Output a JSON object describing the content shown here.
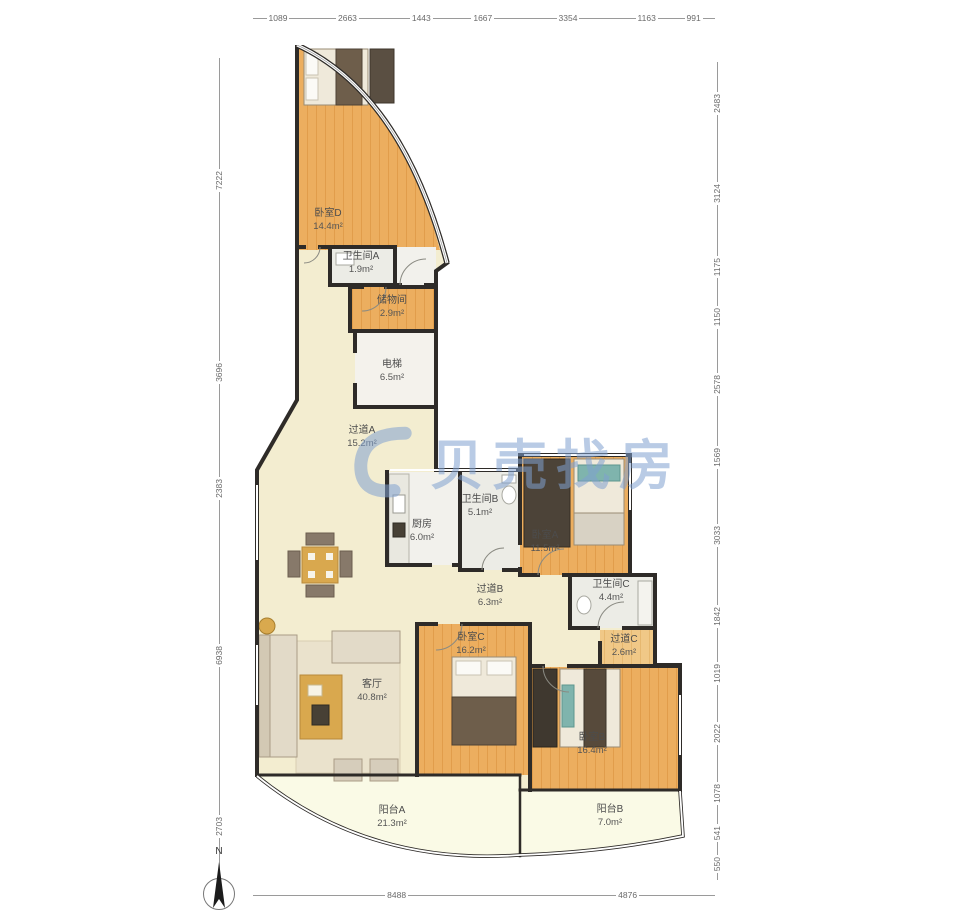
{
  "watermark": {
    "text": "贝壳找房",
    "color": "#80a0d0"
  },
  "compass": {
    "label": "N"
  },
  "rulers": {
    "top": [
      "1089",
      "2663",
      "1443",
      "1667",
      "3354",
      "1163",
      "991"
    ],
    "left": [
      "7222",
      "3696",
      "2383",
      "6938",
      "2703"
    ],
    "right": [
      "2483",
      "3124",
      "1175",
      "1150",
      "2578",
      "1569",
      "3033",
      "1842",
      "1019",
      "2022",
      "1078",
      "541",
      "550"
    ],
    "bottom": [
      "8488",
      "4876"
    ]
  },
  "rooms": [
    {
      "id": "bedroom-d",
      "name": "卧室D",
      "area": "14.4m²"
    },
    {
      "id": "bathroom-a",
      "name": "卫生间A",
      "area": "1.9m²"
    },
    {
      "id": "storage",
      "name": "储物间",
      "area": "2.9m²"
    },
    {
      "id": "elevator",
      "name": "电梯",
      "area": "6.5m²"
    },
    {
      "id": "hallway-a",
      "name": "过道A",
      "area": "15.2m²"
    },
    {
      "id": "kitchen",
      "name": "厨房",
      "area": "6.0m²"
    },
    {
      "id": "bathroom-b",
      "name": "卫生间B",
      "area": "5.1m²"
    },
    {
      "id": "bedroom-a",
      "name": "卧室A",
      "area": "11.5m²"
    },
    {
      "id": "hallway-b",
      "name": "过道B",
      "area": "6.3m²"
    },
    {
      "id": "bathroom-c",
      "name": "卫生间C",
      "area": "4.4m²"
    },
    {
      "id": "bedroom-c",
      "name": "卧室C",
      "area": "16.2m²"
    },
    {
      "id": "hallway-c",
      "name": "过道C",
      "area": "2.6m²"
    },
    {
      "id": "living-room",
      "name": "客厅",
      "area": "40.8m²"
    },
    {
      "id": "bedroom-b",
      "name": "卧室B",
      "area": "16.4m²"
    },
    {
      "id": "balcony-a",
      "name": "阳台A",
      "area": "21.3m²"
    },
    {
      "id": "balcony-b",
      "name": "阳台B",
      "area": "7.0m²"
    }
  ],
  "colors": {
    "wall": "#2e2b28",
    "wood_floor": "#ecae5f",
    "cream_floor": "#f3edd0",
    "tile_floor": "#ececE6",
    "balcony_floor": "#fafae6",
    "ruler": "#9a9a9a"
  }
}
